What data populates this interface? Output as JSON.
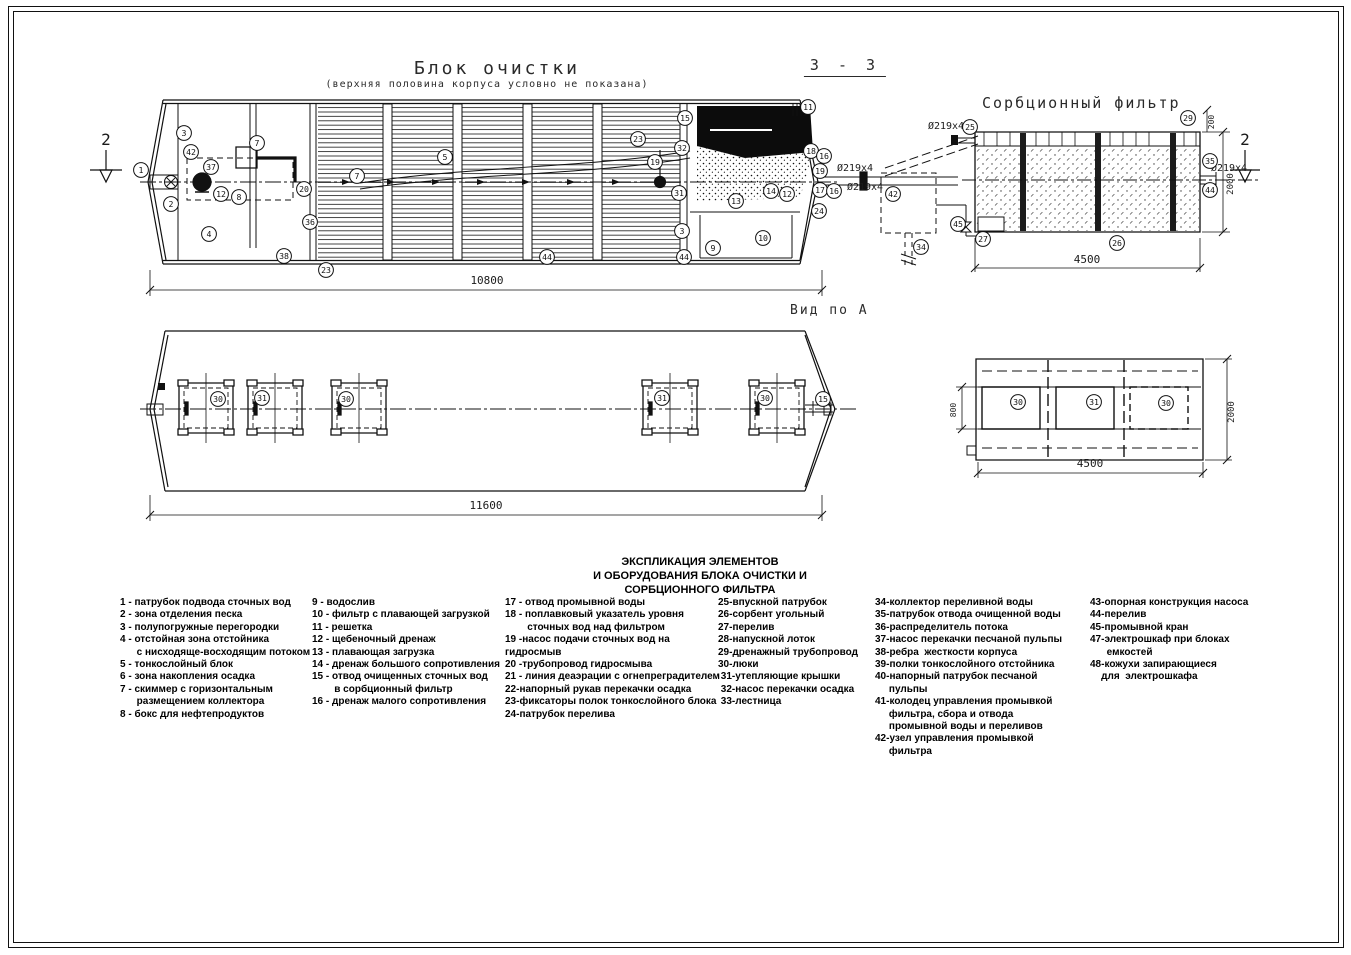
{
  "titles": {
    "block_title": "Блок очистки",
    "block_subtitle": "(верхняя половина корпуса условно не показана)",
    "section_label": "З - З",
    "sorption_title": "Сорбционный фильтр",
    "view_label": "Вид по А"
  },
  "legend": {
    "heading_lines": "ЭКСПЛИКАЦИЯ ЭЛЕМЕНТОВ\nИ ОБОРУДОВАНИЯ  БЛОКА ОЧИСТКИ И\nСОРБЦИОННОГО ФИЛЬТРА",
    "columns": [
      [
        "1 - патрубок подвода сточных вод",
        "2 - зона отделения песка",
        "3 - полупогружные перегородки",
        "4 - отстойная зона отстойника\n      с нисходяще-восходящим потоком",
        "5 - тонкослойный блок",
        "6 - зона накопления осадка",
        "7 - скиммер с горизонтальным\n      размещением коллектора",
        "8 - бокс для нефтепродуктов"
      ],
      [
        "9 - водослив",
        "10 - фильтр с плавающей загрузкой",
        "11 - решетка",
        "12 - щебеночный дренаж",
        "13 - плавающая загрузка",
        "14 - дренаж большого сопротивления",
        "15 - отвод очищенных сточных вод\n        в сорбционный фильтр",
        "16 - дренаж малого сопротивления"
      ],
      [
        "17 - отвод промывной воды",
        "18 - поплавковый указатель уровня\n        сточных вод над фильтром",
        "19 -насос подачи сточных вод на гидросмыв",
        "20 -трубопровод гидросмыва",
        "21 - линия деаэрации с огнепреградителем",
        "22-напорный рукав перекачки осадка",
        "23-фиксаторы полок тонкослойного блока",
        "24-патрубок перелива"
      ],
      [
        "25-впускной патрубок",
        "26-сорбент угольный",
        "27-перелив",
        "28-напускной лоток",
        "29-дренажный трубопровод",
        "30-люки",
        " 31-утепляющие крышки",
        " 32-насос перекачки осадка",
        " 33-лестница"
      ],
      [
        "34-коллектор переливной воды",
        "35-патрубок отвода очищенной воды",
        "36-распределитель потока",
        "37-насос перекачки песчаной пульпы",
        "38-ребра  жесткости корпуса",
        "39-полки тонкослойного отстойника",
        "40-напорный патрубок песчаной\n     пульпы",
        "41-колодец управления промывкой\n     фильтра, сбора и отвода\n     промывной воды и переливов",
        "42-узел управления промывкой\n     фильтра"
      ],
      [
        "43-опорная конструкция насоса",
        "44-перелив",
        "45-промывной кран",
        "47-электрошкаф при блоках\n      емкостей",
        "48-кожухи запирающиеся\n    для  электрошкафа"
      ]
    ]
  },
  "drawing": {
    "callouts": [
      {
        "n": "1",
        "x": 141,
        "y": 170
      },
      {
        "n": "3",
        "x": 184,
        "y": 133
      },
      {
        "n": "42",
        "x": 191,
        "y": 152
      },
      {
        "n": "37",
        "x": 211,
        "y": 167
      },
      {
        "n": "2",
        "x": 171,
        "y": 204
      },
      {
        "n": "4",
        "x": 209,
        "y": 234
      },
      {
        "n": "12",
        "x": 221,
        "y": 194
      },
      {
        "n": "8",
        "x": 239,
        "y": 197
      },
      {
        "n": "7",
        "x": 257,
        "y": 143
      },
      {
        "n": "7",
        "x": 357,
        "y": 176
      },
      {
        "n": "5",
        "x": 445,
        "y": 157
      },
      {
        "n": "20",
        "x": 304,
        "y": 189
      },
      {
        "n": "36",
        "x": 310,
        "y": 222
      },
      {
        "n": "38",
        "x": 284,
        "y": 256
      },
      {
        "n": "23",
        "x": 326,
        "y": 270
      },
      {
        "n": "44",
        "x": 547,
        "y": 257
      },
      {
        "n": "23",
        "x": 638,
        "y": 139
      },
      {
        "n": "15",
        "x": 685,
        "y": 118
      },
      {
        "n": "11",
        "x": 808,
        "y": 107
      },
      {
        "n": "32",
        "x": 682,
        "y": 148
      },
      {
        "n": "19",
        "x": 655,
        "y": 162
      },
      {
        "n": "31",
        "x": 679,
        "y": 193
      },
      {
        "n": "13",
        "x": 736,
        "y": 201
      },
      {
        "n": "14",
        "x": 771,
        "y": 191
      },
      {
        "n": "12",
        "x": 787,
        "y": 194
      },
      {
        "n": "3",
        "x": 682,
        "y": 231
      },
      {
        "n": "9",
        "x": 713,
        "y": 248
      },
      {
        "n": "10",
        "x": 763,
        "y": 238
      },
      {
        "n": "44",
        "x": 684,
        "y": 257
      },
      {
        "n": "18",
        "x": 811,
        "y": 151
      },
      {
        "n": "16",
        "x": 824,
        "y": 156
      },
      {
        "n": "19",
        "x": 820,
        "y": 171
      },
      {
        "n": "17",
        "x": 820,
        "y": 190
      },
      {
        "n": "16",
        "x": 834,
        "y": 191
      },
      {
        "n": "24",
        "x": 819,
        "y": 211
      },
      {
        "n": "42",
        "x": 893,
        "y": 194
      },
      {
        "n": "34",
        "x": 921,
        "y": 247
      },
      {
        "n": "45",
        "x": 958,
        "y": 224
      },
      {
        "n": "25",
        "x": 970,
        "y": 127
      },
      {
        "n": "27",
        "x": 983,
        "y": 239
      },
      {
        "n": "29",
        "x": 1188,
        "y": 118
      },
      {
        "n": "35",
        "x": 1210,
        "y": 161
      },
      {
        "n": "44",
        "x": 1210,
        "y": 190
      },
      {
        "n": "26",
        "x": 1117,
        "y": 243
      },
      {
        "n": "30",
        "x": 218,
        "y": 399
      },
      {
        "n": "31",
        "x": 262,
        "y": 398
      },
      {
        "n": "30",
        "x": 346,
        "y": 399
      },
      {
        "n": "31",
        "x": 662,
        "y": 398
      },
      {
        "n": "30",
        "x": 765,
        "y": 398
      },
      {
        "n": "15",
        "x": 823,
        "y": 399
      },
      {
        "n": "30",
        "x": 1018,
        "y": 402
      },
      {
        "n": "31",
        "x": 1094,
        "y": 402
      },
      {
        "n": "30",
        "x": 1166,
        "y": 403
      }
    ],
    "labels": [
      {
        "t": "10800",
        "x": 487,
        "y": 284,
        "fs": 11
      },
      {
        "t": "11600",
        "x": 486,
        "y": 509,
        "fs": 11
      },
      {
        "t": "4500",
        "x": 1087,
        "y": 263,
        "fs": 11
      },
      {
        "t": "4500",
        "x": 1090,
        "y": 467,
        "fs": 11
      },
      {
        "t": "2000",
        "x": 1233,
        "y": 184,
        "r": -90,
        "fs": 9
      },
      {
        "t": "200",
        "x": 1214,
        "y": 122,
        "r": -90,
        "fs": 8
      },
      {
        "t": "2000",
        "x": 1234,
        "y": 412,
        "r": -90,
        "fs": 9
      },
      {
        "t": "800",
        "x": 956,
        "y": 410,
        "r": -90,
        "fs": 8
      },
      {
        "t": "Ø219x4",
        "x": 946,
        "y": 129,
        "fs": 10
      },
      {
        "t": "Ø219x4",
        "x": 855,
        "y": 171,
        "fs": 10
      },
      {
        "t": "Ø219x4",
        "x": 865,
        "y": 190,
        "fs": 10
      },
      {
        "t": "Ø219x4",
        "x": 1229,
        "y": 171,
        "fs": 10
      },
      {
        "t": "2",
        "x": 106,
        "y": 145,
        "fs": 16
      },
      {
        "t": "2",
        "x": 1245,
        "y": 145,
        "fs": 16
      }
    ]
  }
}
